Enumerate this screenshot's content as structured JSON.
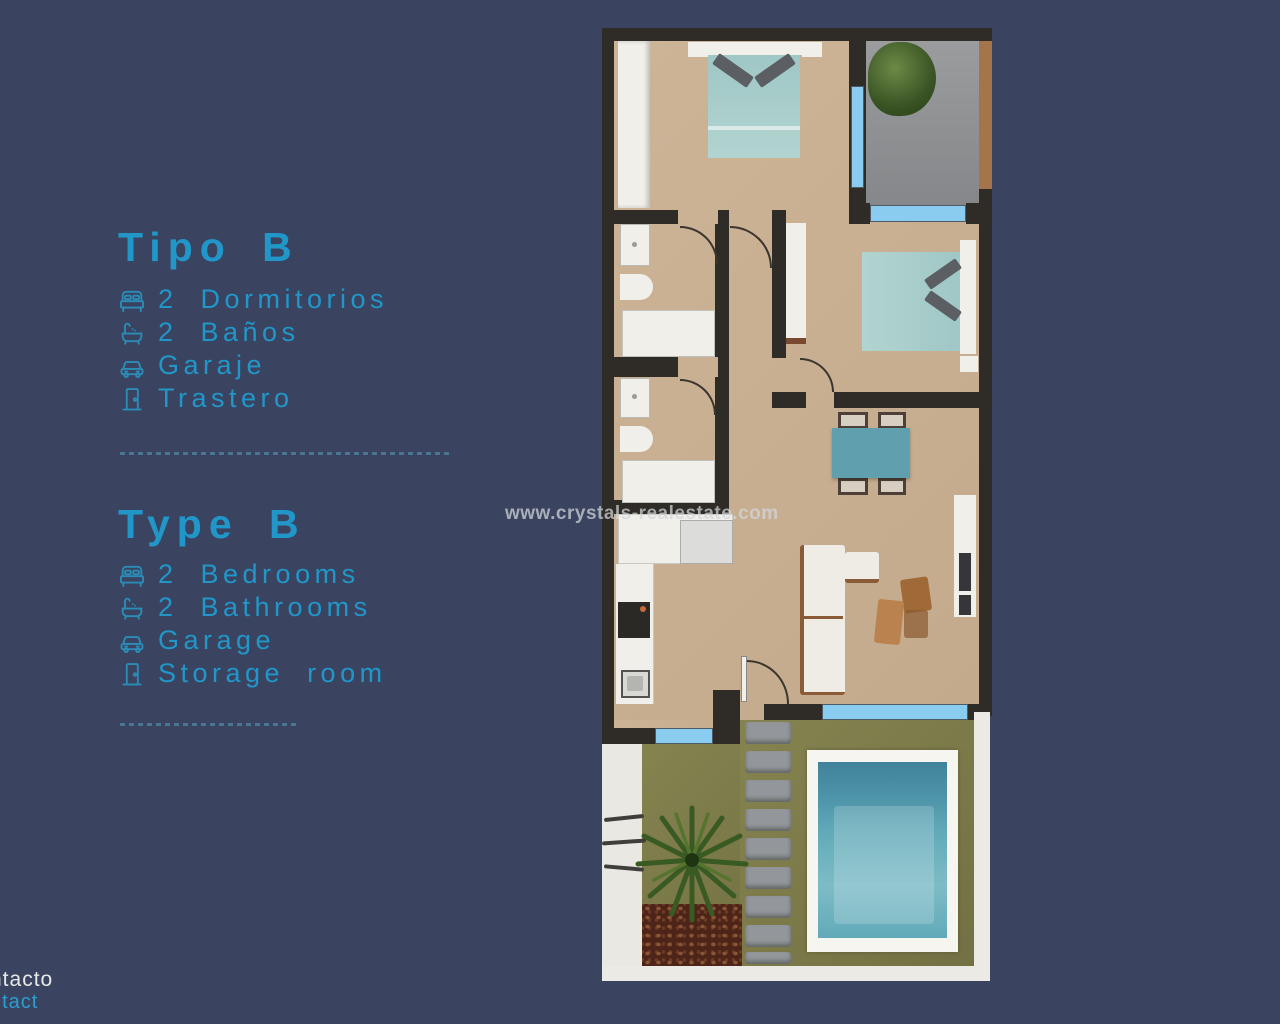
{
  "sections": [
    {
      "id": "tipo-b",
      "title": "Tipo B",
      "features": [
        {
          "icon": "bed-icon",
          "label": "2 Dormitorios"
        },
        {
          "icon": "bathtub-icon",
          "label": "2 Baños"
        },
        {
          "icon": "car-icon",
          "label": "Garaje"
        },
        {
          "icon": "door-icon",
          "label": "Trastero"
        }
      ]
    },
    {
      "id": "type-b",
      "title": "Type B",
      "features": [
        {
          "icon": "bed-icon",
          "label": "2 Bedrooms"
        },
        {
          "icon": "bathtub-icon",
          "label": "2 Bathrooms"
        },
        {
          "icon": "car-icon",
          "label": "Garage"
        },
        {
          "icon": "door-icon",
          "label": "Storage room"
        }
      ]
    }
  ],
  "watermark": {
    "text": "www.crystals-realestate.com"
  },
  "footer": {
    "contact_es": "ntacto",
    "contact_en": "ntact"
  },
  "colors": {
    "background": "#3a4460",
    "accent_cyan": "#2196c9",
    "icon_cyan": "#2b8cb8",
    "wall": "#2f2b26",
    "floor_beige": "#c8af92",
    "garage_gray": "#8f9193",
    "window_blue": "#8accf0",
    "bed_teal": "#a9cfcc",
    "table_teal": "#5f9fae",
    "pool_water": "#62aab9",
    "garden_olive": "#7c7a4b"
  }
}
